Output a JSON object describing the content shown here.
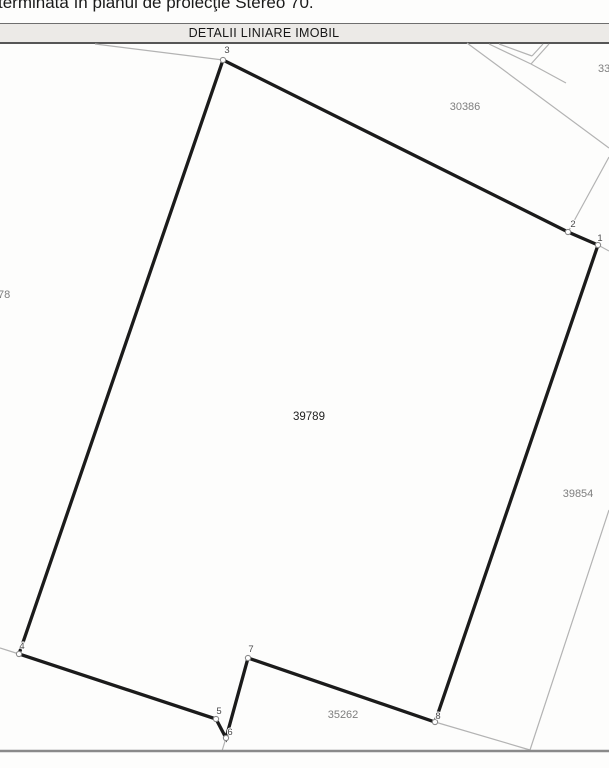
{
  "page": {
    "top_text": "terminată în planul de proiecţie Stereo 70.",
    "header_title": "DETALII LINIARE IMOBIL"
  },
  "colors": {
    "thick_line": "#1b1b1b",
    "thin_line": "#b3b3b3",
    "bottom_line": "#8a8a8a",
    "neighbor_label": "#7e7e7e",
    "main_label": "#1f1f1f",
    "vertex_label": "#4a4a4a",
    "marker_stroke": "#8a8a8a",
    "marker_fill": "#ffffff"
  },
  "plan": {
    "main_parcel": {
      "number": "39789",
      "x": 309,
      "y": 420
    },
    "outline_points": [
      [
        223,
        60
      ],
      [
        568,
        232
      ],
      [
        598,
        245
      ],
      [
        435,
        722
      ],
      [
        248,
        658
      ],
      [
        226,
        738
      ],
      [
        216,
        719
      ],
      [
        19,
        654
      ]
    ],
    "vertices": [
      {
        "n": "1",
        "x": 598,
        "y": 245,
        "lx": 600,
        "ly": 241
      },
      {
        "n": "2",
        "x": 568,
        "y": 232,
        "lx": 573,
        "ly": 227
      },
      {
        "n": "3",
        "x": 223,
        "y": 60,
        "lx": 227,
        "ly": 53
      },
      {
        "n": "4",
        "x": 19,
        "y": 654,
        "lx": 22,
        "ly": 649
      },
      {
        "n": "5",
        "x": 216,
        "y": 719,
        "lx": 219,
        "ly": 714
      },
      {
        "n": "6",
        "x": 226,
        "y": 738,
        "lx": 230,
        "ly": 735
      },
      {
        "n": "7",
        "x": 248,
        "y": 658,
        "lx": 251,
        "ly": 652
      },
      {
        "n": "8",
        "x": 435,
        "y": 722,
        "lx": 438,
        "ly": 719
      }
    ],
    "neighbor_parcels": [
      {
        "number": "30386",
        "x": 465,
        "y": 110,
        "anchor": "middle"
      },
      {
        "number": "33",
        "x": 598,
        "y": 72,
        "anchor": "start"
      },
      {
        "number": "78",
        "x": -2,
        "y": 298,
        "anchor": "start"
      },
      {
        "number": "39854",
        "x": 578,
        "y": 497,
        "anchor": "middle"
      },
      {
        "number": "35262",
        "x": 343,
        "y": 718,
        "anchor": "middle"
      }
    ],
    "thin_lines": [
      [
        95,
        44,
        223,
        60
      ],
      [
        467,
        43,
        609,
        148
      ],
      [
        489,
        44,
        531,
        64
      ],
      [
        531,
        64,
        549,
        44
      ],
      [
        499,
        44,
        532,
        56
      ],
      [
        532,
        56,
        543,
        44
      ],
      [
        531,
        64,
        566,
        83
      ],
      [
        609,
        157,
        568,
        232
      ],
      [
        598,
        245,
        609,
        251
      ],
      [
        609,
        510,
        530,
        750
      ],
      [
        435,
        722,
        530,
        750
      ],
      [
        0,
        648,
        19,
        654
      ],
      [
        226,
        738,
        222,
        751
      ]
    ],
    "bottom_line": [
      0,
      751,
      609,
      751
    ]
  }
}
